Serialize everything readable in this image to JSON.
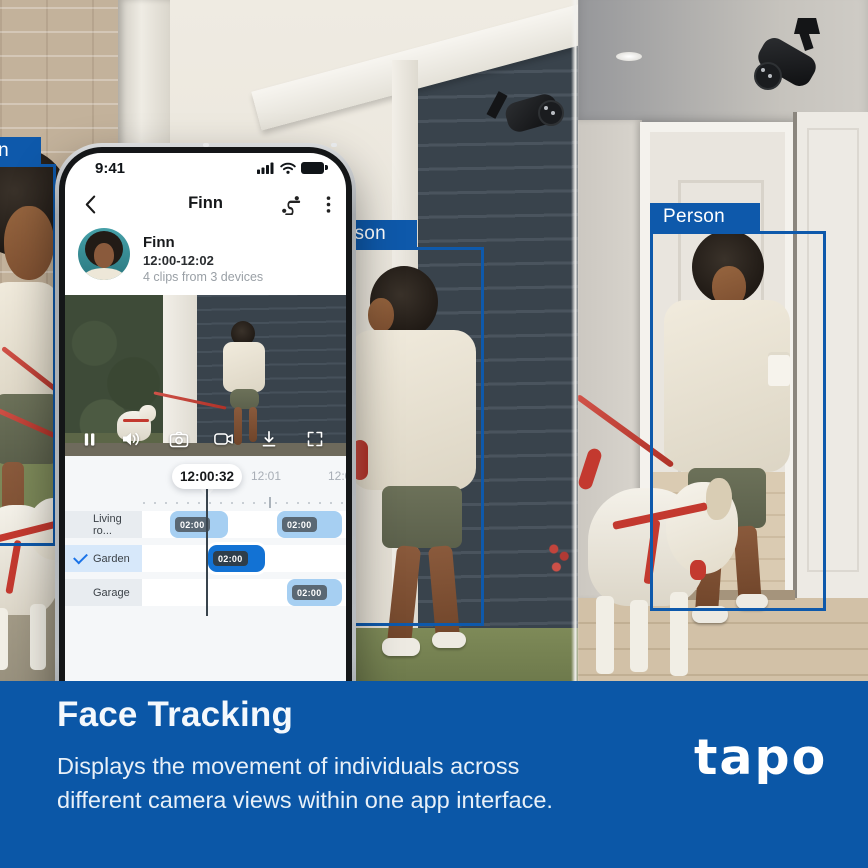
{
  "scene": {
    "left_camera_view": {
      "detection_label": "Person"
    },
    "middle_camera_view": {
      "detection_label": "Person"
    },
    "right_camera_view": {
      "detection_label": "Person"
    }
  },
  "phone": {
    "status_bar": {
      "time": "9:41"
    },
    "header": {
      "title": "Finn"
    },
    "profile": {
      "name": "Finn",
      "time_range": "12:00-12:02",
      "clips_summary": "4 clips from 3 devices"
    },
    "timeline": {
      "playhead_time": "12:00:32",
      "tick_labels": [
        "12:01",
        "12:02"
      ],
      "rows": [
        {
          "label": "Living ro...",
          "selected": false,
          "clips": [
            {
              "duration": "02:00"
            },
            {
              "duration": "02:00"
            }
          ]
        },
        {
          "label": "Garden",
          "selected": true,
          "clips": [
            {
              "duration": "02:00"
            }
          ]
        },
        {
          "label": "Garage",
          "selected": false,
          "clips": [
            {
              "duration": "02:00"
            }
          ]
        }
      ]
    }
  },
  "banner": {
    "title": "Face Tracking",
    "description": [
      "Displays the movement of individuals across",
      "different camera views within one app interface."
    ],
    "logo_text": "tapo"
  },
  "colors": {
    "banner_bg": "#0B57A7",
    "detection_blue": "#0E59AB",
    "clip_blue": "#A6CFF2",
    "clip_selected_blue": "#1272D4",
    "check_blue": "#1A73E8"
  }
}
